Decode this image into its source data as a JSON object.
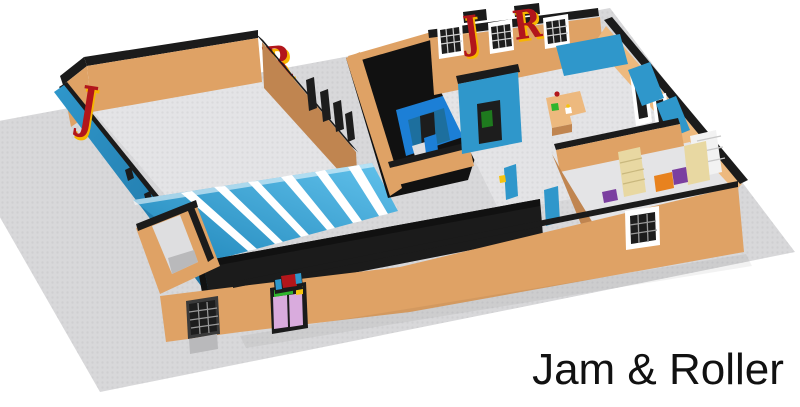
{
  "caption": {
    "text": "Jam & Roller"
  },
  "signage": {
    "rink_left_letter": "J",
    "rink_right_letter": "R",
    "lounge_wall_letters": [
      "J",
      "R"
    ]
  },
  "scene": {
    "description_objects": [
      "gray-lego-baseplate",
      "roller-rink-room",
      "striped-arched-roof",
      "entrance-vestibule",
      "black-corridor",
      "bathroom-block",
      "lounge-room",
      "snack-bar-counter",
      "wall-benches",
      "skate-rental-room",
      "lavender-double-door",
      "lattice-windows"
    ]
  },
  "palette": {
    "baseplate": "#d8d8da",
    "floor_gray": "#e4e4e6",
    "wall_tan": "#dfa265",
    "wall_tan_light": "#edb97e",
    "wall_tan_dark": "#c08550",
    "trim_black": "#1b1b1b",
    "wall_blue": "#2f97cb",
    "wall_blue_dark": "#1d6f9e",
    "roof_blue_light": "#62c2ec",
    "roof_blue_dark": "#1f86ba",
    "roof_stripe": "#ffffff",
    "bathroom_blue": "#1c7fd6",
    "letter_red": "#b2161b",
    "letter_yellow": "#f7b500",
    "door_lavender": "#d9abdd",
    "sign_green": "#2eb52c",
    "accent_yellow": "#f5c40f",
    "box_orange": "#e8821e",
    "box_purple": "#7b3fa0",
    "shelf_beige": "#e8d8a2",
    "caption_black": "#111111"
  }
}
